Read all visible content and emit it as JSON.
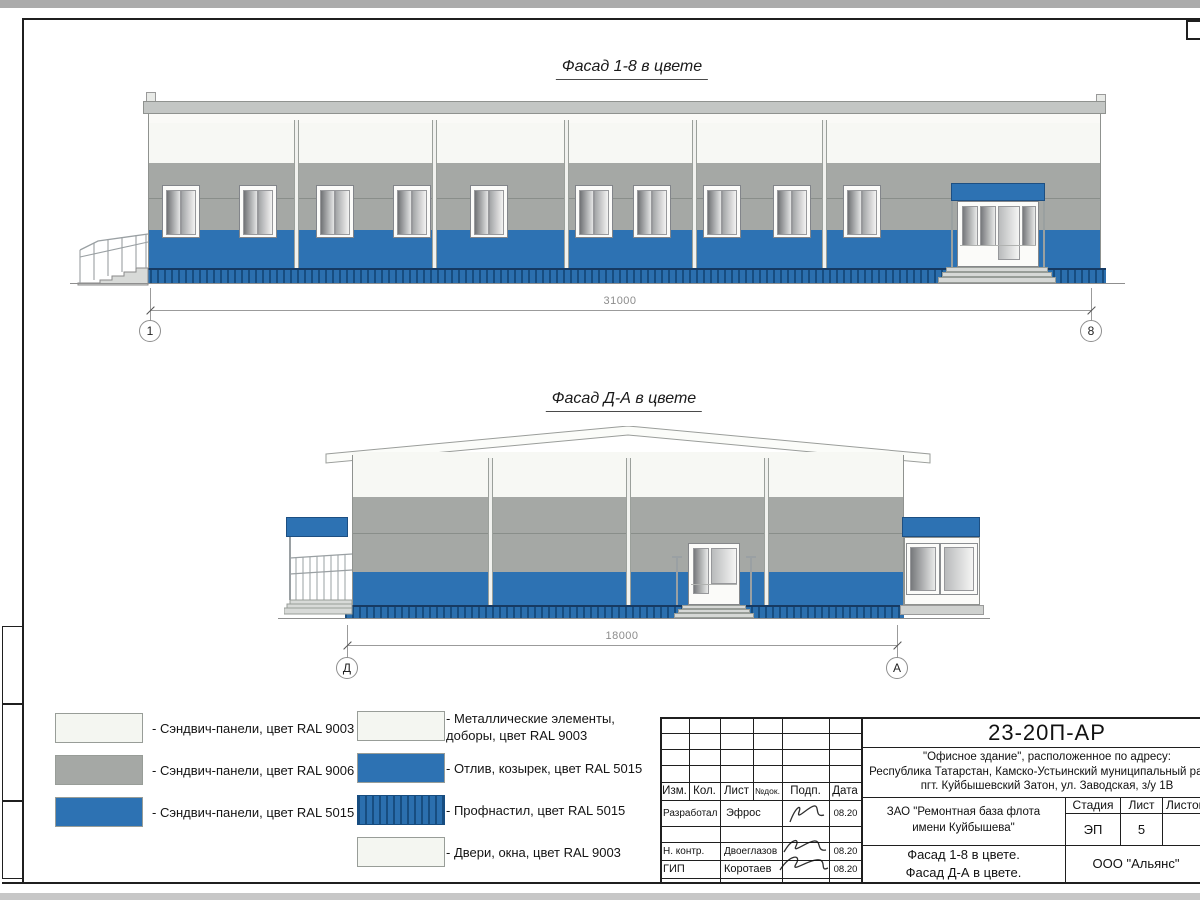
{
  "facade1": {
    "title": "Фасад 1-8 в цвете",
    "dimension": "31000",
    "axis_left": "1",
    "axis_right": "8"
  },
  "facade2": {
    "title": "Фасад Д-А в цвете",
    "dimension": "18000",
    "axis_left": "Д",
    "axis_right": "А"
  },
  "legend": {
    "left": [
      {
        "swatch": "ral9003",
        "label": "- Сэндвич-панели, цвет RAL 9003"
      },
      {
        "swatch": "ral9006",
        "label": "- Сэндвич-панели, цвет RAL 9006"
      },
      {
        "swatch": "ral5015",
        "label": "- Сэндвич-панели, цвет RAL 5015"
      }
    ],
    "right": [
      {
        "swatch": "ral9003",
        "label": "- Металлические элементы, доборы, цвет RAL 9003"
      },
      {
        "swatch": "ral5015",
        "label": "- Отлив, козырек, цвет RAL 5015"
      },
      {
        "swatch": "profnastil",
        "label": "- Профнастил, цвет RAL 5015"
      },
      {
        "swatch": "ral9003",
        "label": "- Двери, окна, цвет RAL 9003"
      }
    ]
  },
  "colors": {
    "ral9003": "#f4f6f1",
    "ral9006": "#a5a8a5",
    "ral5015": "#2d72b3",
    "profnastil_stripe": "#174d80",
    "roof_cap": "#c3c6c4"
  },
  "title_block": {
    "doc_number": "23-20П-АР",
    "address_line1": "\"Офисное здание\", расположенное по адресу:",
    "address_line2": "Республика Татарстан, Камско-Устьинский муниципальный район,",
    "address_line3": "пгт. Куйбышевский Затон, ул. Заводская, з/у 1В",
    "columns": {
      "izm": "Изм.",
      "kol": "Кол.",
      "list": "Лист",
      "ndok": "№док.",
      "podp": "Подп.",
      "data": "Дата"
    },
    "rows": [
      {
        "role": "Разработал",
        "name": "Эфрос",
        "date": "08.20"
      },
      {
        "role": "Н. контр.",
        "name": "Двоеглазов",
        "date": "08.20"
      },
      {
        "role": "ГИП",
        "name": "Коротаев",
        "date": "08.20"
      }
    ],
    "client_line1": "ЗАО \"Ремонтная база флота",
    "client_line2": "имени Куйбышева\"",
    "stage_label": "Стадия",
    "sheet_label": "Лист",
    "sheets_label": "Листов",
    "stage_value": "ЭП",
    "sheet_value": "5",
    "subject_line1": "Фасад 1-8 в цвете.",
    "subject_line2": "Фасад Д-А в цвете.",
    "company": "ООО \"Альянс\""
  }
}
